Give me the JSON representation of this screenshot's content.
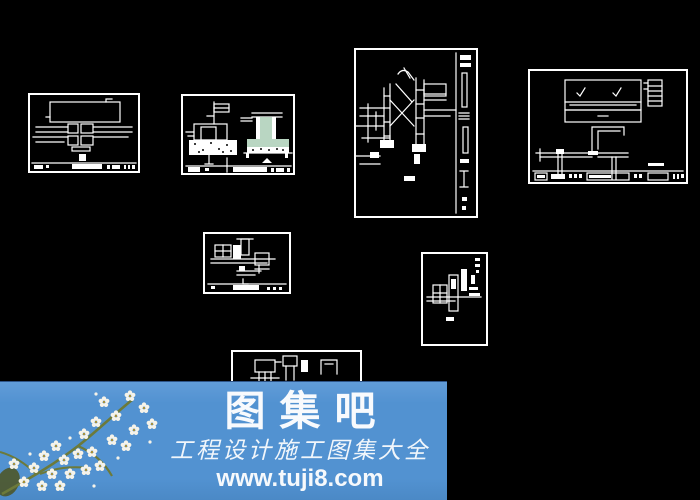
{
  "canvas": {
    "background": "#000000",
    "line_color": "#ffffff",
    "hatch_green": "#b9d6c2"
  },
  "watermark": {
    "band_color": "#5292d1",
    "text_color": "#ffffff",
    "branch_color": "#6c7a3a",
    "petal_color": "#f6f3e9",
    "site_name": "图集吧",
    "tagline": "工程设计施工图集大全",
    "url": "www.tuji8.com"
  }
}
